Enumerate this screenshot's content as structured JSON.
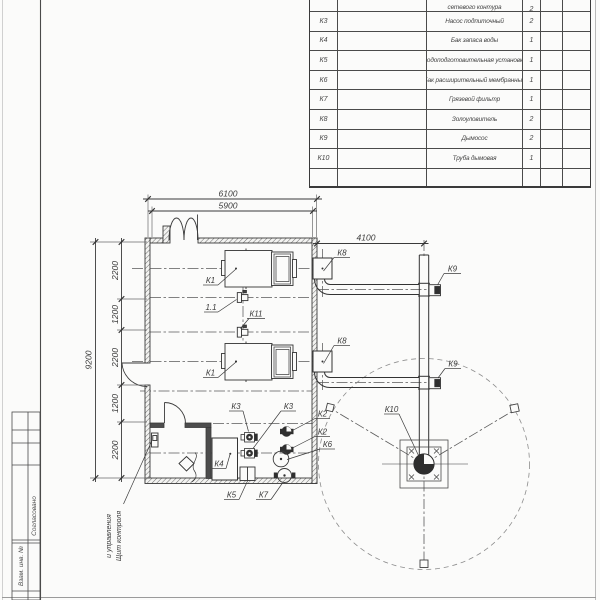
{
  "drawing": {
    "spec_table": {
      "rows": [
        {
          "pos": "К2",
          "name": "сетевого контура",
          "qty": "2"
        },
        {
          "pos": "К3",
          "name": "Насос подпиточный",
          "qty": "2"
        },
        {
          "pos": "К4",
          "name": "Бак запаса воды",
          "qty": "1"
        },
        {
          "pos": "К5",
          "name": "Водоподготовительная установка",
          "qty": "1"
        },
        {
          "pos": "К6",
          "name": "Бак расширительный мембранный",
          "qty": "1"
        },
        {
          "pos": "К7",
          "name": "Грязевой фильтр",
          "qty": "1"
        },
        {
          "pos": "К8",
          "name": "Золоуловитель",
          "qty": "2"
        },
        {
          "pos": "К9",
          "name": "Дымосос",
          "qty": "2"
        },
        {
          "pos": "К10",
          "name": "Труба дымовая",
          "qty": "1"
        },
        {
          "pos": "",
          "name": "",
          "qty": ""
        }
      ]
    },
    "dimensions": {
      "top_outer": "6100",
      "top_inner": "5900",
      "flue_offset": "4100",
      "left_overall": "9200",
      "left_chain": [
        "2200",
        "1200",
        "2200",
        "1200",
        "2200"
      ]
    },
    "labels": {
      "boiler1": "К1",
      "boiler2": "К1",
      "valve_small": "1.1",
      "valve_k11": "К11",
      "k2a": "К2",
      "k2b": "К2",
      "k3a": "К3",
      "k3b": "К3",
      "k4": "К4",
      "k5": "К5",
      "k6": "К6",
      "k7": "К7",
      "k8a": "К8",
      "k8b": "К8",
      "k9a": "К9",
      "k9b": "К9",
      "k10": "К10"
    },
    "annotations": {
      "control_panel_line1": "Щит контроля",
      "control_panel_line2": "и управления"
    },
    "title_block": {
      "stamp_agree": "Согласовано",
      "stamp_inv": "Взам. инв. №"
    }
  }
}
